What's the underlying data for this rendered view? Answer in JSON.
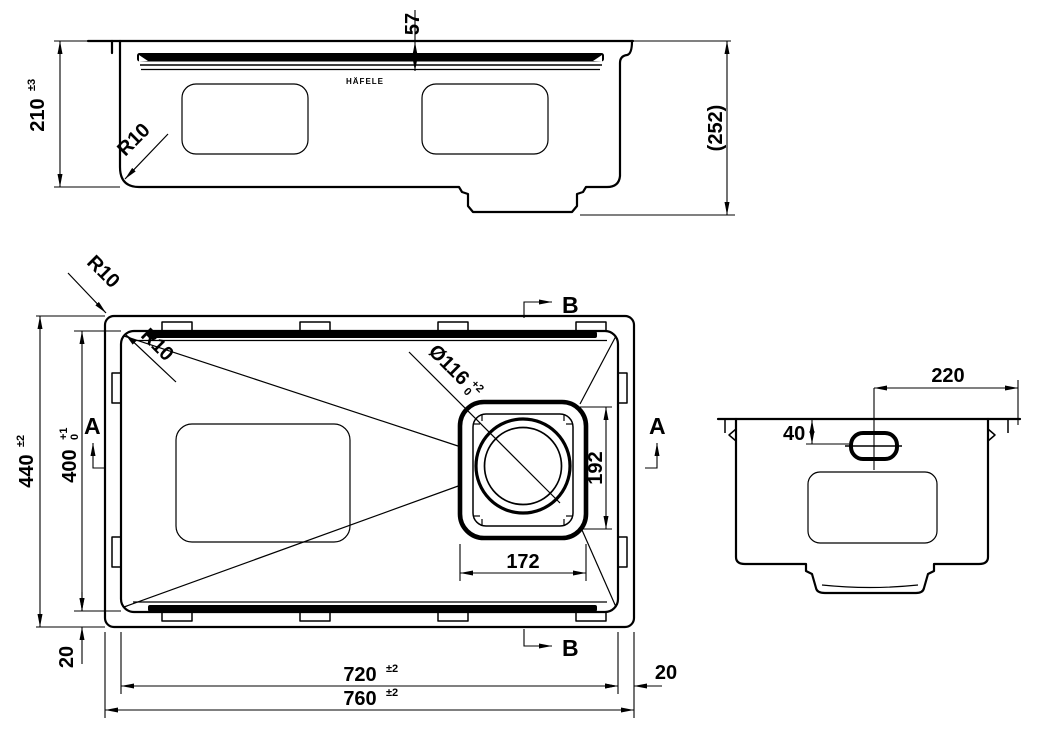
{
  "brand": {
    "logo": "HÄFELE"
  },
  "front_view": {
    "height": {
      "value": "210",
      "tol": "±3"
    },
    "step_depth": {
      "value": "57"
    },
    "overall_height": {
      "value": "(252)"
    },
    "corner_radius": {
      "value": "R10"
    }
  },
  "plan_view": {
    "outer_corner_radius": {
      "value": "R10"
    },
    "inner_corner_radius": {
      "value": "R10"
    },
    "outer_depth": {
      "value": "440",
      "tol": "±2"
    },
    "inner_depth": {
      "value": "400",
      "tol_upper": "+1",
      "tol_lower": "0"
    },
    "drain_diameter": {
      "value": "Ø116",
      "tol_upper": "+2",
      "tol_lower": "0"
    },
    "drain_recess_height": {
      "value": "192"
    },
    "drain_recess_width": {
      "value": "172"
    },
    "flange_offset_bottom": {
      "value": "20"
    },
    "flange_offset_right": {
      "value": "20"
    },
    "inner_width": {
      "value": "720",
      "tol": "±2"
    },
    "outer_width": {
      "value": "760",
      "tol": "±2"
    },
    "section_a_label": "A",
    "section_b_label": "B"
  },
  "section_view": {
    "overflow_offset": {
      "value": "220"
    },
    "overflow_depth": {
      "value": "40"
    }
  }
}
